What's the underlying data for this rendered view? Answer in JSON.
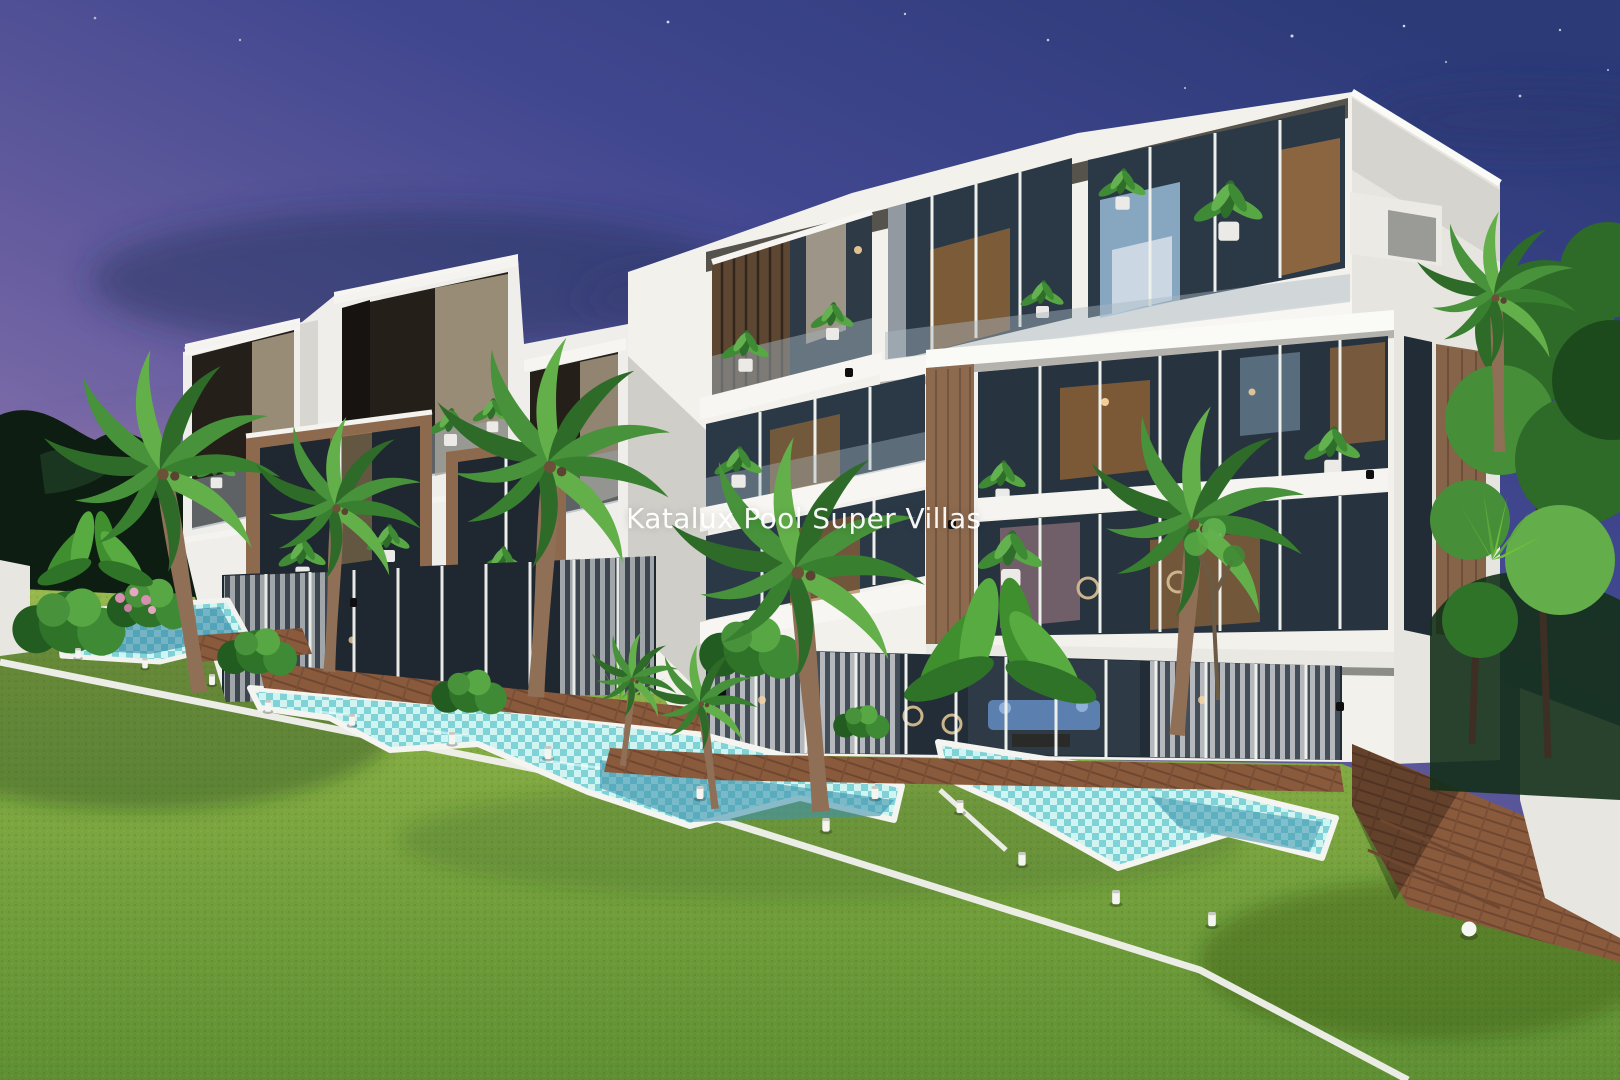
{
  "watermark": {
    "text": "Katalux Pool Super Villas"
  },
  "scene": {
    "description": "Dusk 3D architectural rendering of modern white multi-storey pool villas with wood-accent balconies, private turquoise mosaic pools, wooden decks, lawn, palm trees and path lights",
    "time_of_day": "dusk",
    "elements": [
      "sky",
      "stars",
      "clouds",
      "tree-line",
      "villa-left",
      "villa-right",
      "balconies",
      "balcony-plants",
      "glass-walls",
      "pools",
      "wooden-deck",
      "lawn",
      "curb-lines",
      "palm-trees",
      "path-lights",
      "watermark"
    ]
  },
  "colors": {
    "sky_top": "#2c3a78",
    "sky_mid": "#665d9f",
    "sky_horizon": "#d3abc6",
    "building_white": "#f2f1ec",
    "building_shade": "#d6d5d0",
    "window_glass": "#27333f",
    "wood_accent": "#8d6a4e",
    "deck_wood": "#8a5a3c",
    "pool_water": "#a9e8e6",
    "pool_deep": "#3f93ad",
    "grass": "#7aa53f",
    "foliage": "#3f8a34"
  }
}
